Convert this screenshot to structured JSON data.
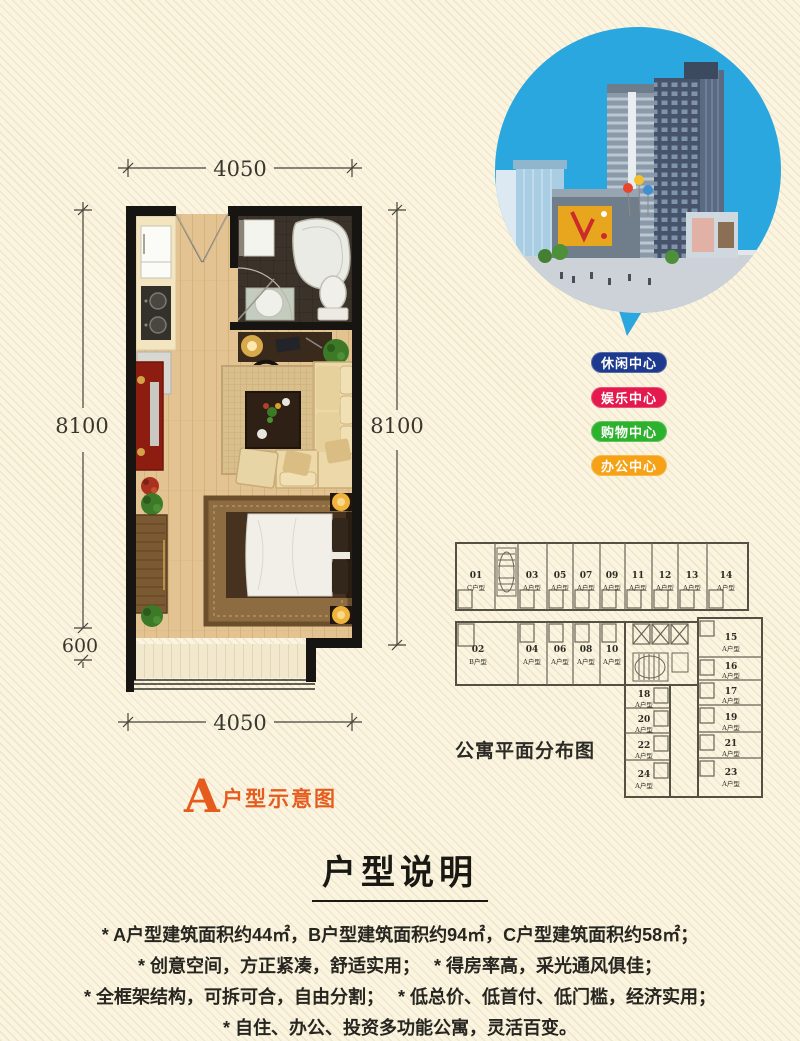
{
  "page": {
    "bg_color": "#faf4e0",
    "stripe_color": "#e9dfc0"
  },
  "floor_plan": {
    "label_letter": "A",
    "label_rest": "户型示意图",
    "accent_color": "#e65c1e",
    "dims": {
      "top": "4050",
      "bottom": "4050",
      "left": "8100",
      "left_lower": "600",
      "right": "8100"
    }
  },
  "balloon": {
    "color": "#2ba7df"
  },
  "badges": [
    {
      "label": "休闲中心",
      "color": "#1e3a8e"
    },
    {
      "label": "娱乐中心",
      "color": "#e4194e"
    },
    {
      "label": "购物中心",
      "color": "#2cb22c"
    },
    {
      "label": "办公中心",
      "color": "#f5a216"
    }
  ],
  "distribution": {
    "title": "公寓平面分布图",
    "units": [
      {
        "no": "01",
        "type": "C户型"
      },
      {
        "no": "03",
        "type": "A户型"
      },
      {
        "no": "05",
        "type": "A户型"
      },
      {
        "no": "07",
        "type": "A户型"
      },
      {
        "no": "09",
        "type": "A户型"
      },
      {
        "no": "11",
        "type": "A户型"
      },
      {
        "no": "12",
        "type": "A户型"
      },
      {
        "no": "13",
        "type": "A户型"
      },
      {
        "no": "14",
        "type": "A户型"
      },
      {
        "no": "02",
        "type": "B户型"
      },
      {
        "no": "04",
        "type": "A户型"
      },
      {
        "no": "06",
        "type": "A户型"
      },
      {
        "no": "08",
        "type": "A户型"
      },
      {
        "no": "10",
        "type": "A户型"
      },
      {
        "no": "15",
        "type": "A户型"
      },
      {
        "no": "16",
        "type": "A户型"
      },
      {
        "no": "17",
        "type": "A户型"
      },
      {
        "no": "19",
        "type": "A户型"
      },
      {
        "no": "21",
        "type": "A户型"
      },
      {
        "no": "23",
        "type": "A户型"
      },
      {
        "no": "18",
        "type": "A户型"
      },
      {
        "no": "20",
        "type": "A户型"
      },
      {
        "no": "22",
        "type": "A户型"
      },
      {
        "no": "24",
        "type": "A户型"
      }
    ]
  },
  "description": {
    "title": "户型说明",
    "lines": [
      "* A户型建筑面积约44㎡，B户型建筑面积约94㎡，C户型建筑面积约58㎡；",
      "* 创意空间，方正紧凑，舒适实用；　 * 得房率高，采光通风俱佳；",
      "* 全框架结构，可拆可合，自由分割；　 * 低总价、低首付、低门槛，经济实用；",
      "* 自住、办公、投资多功能公寓，灵活百变。"
    ]
  }
}
